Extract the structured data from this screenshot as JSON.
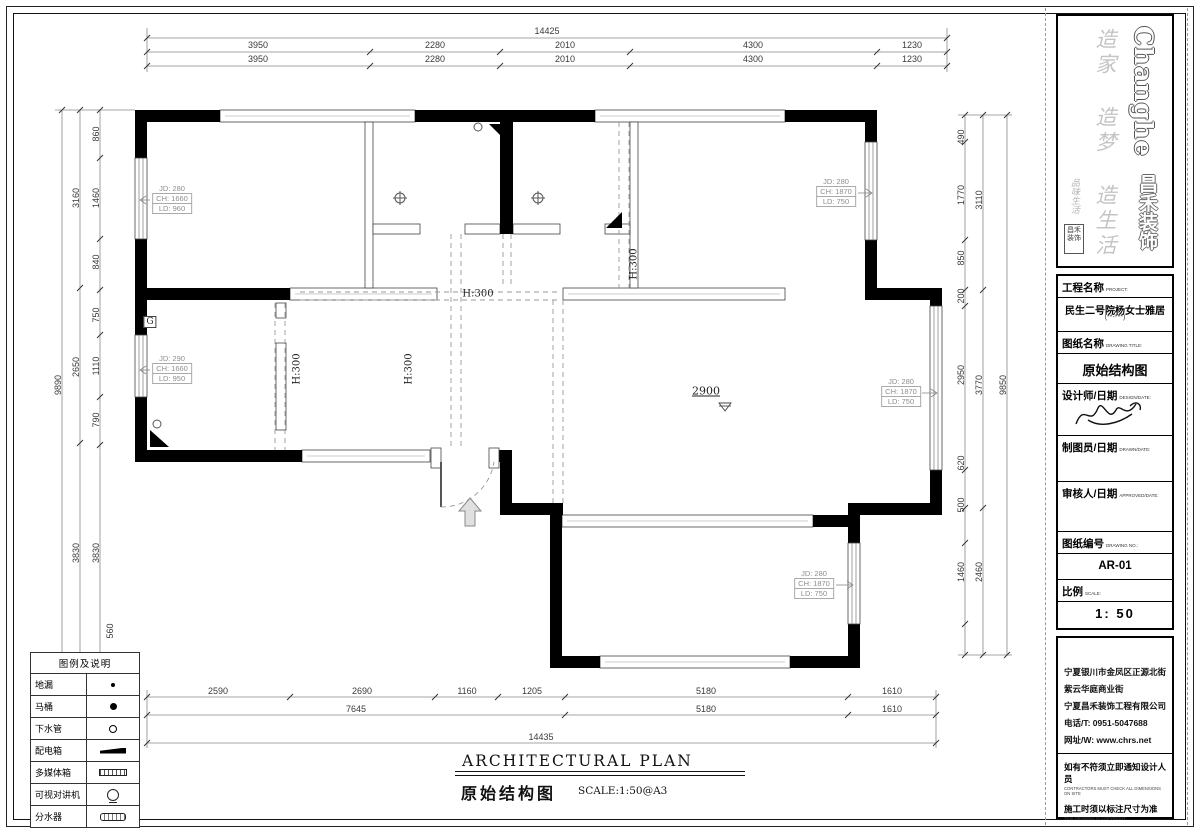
{
  "logo": {
    "brand_en": "Changhe",
    "brand_cn": "昌禾装饰",
    "slogan": "造家 造梦 造生活",
    "calligraphy": "品味生活",
    "seal": "昌禾装饰"
  },
  "title_block": {
    "project_label": "工程名称",
    "project_label_en": "PROJECT:",
    "project_value": "民生二号院杨女士雅居",
    "project_value_sub": "(**-***)",
    "drawing_label": "图纸名称",
    "drawing_label_en": "DRAWING TITLE:",
    "drawing_value": "原始结构图",
    "designer_label": "设计师/日期",
    "designer_label_en": "DESIGN/DATE:",
    "drafter_label": "制图员/日期",
    "drafter_label_en": "DRAWN/DATE:",
    "approver_label": "审核人/日期",
    "approver_label_en": "APPROVED/DATE:",
    "number_label": "图纸编号",
    "number_label_en": "DRAWING NO.:",
    "number_value": "AR-01",
    "scale_label": "比例",
    "scale_label_en": "SCALE:",
    "scale_value": "1: 50"
  },
  "company": {
    "addr1": "宁夏银川市金凤区正源北街",
    "addr2": "紫云华庭商业街",
    "name": "宁夏昌禾装饰工程有限公司",
    "phone": "电话/T: 0951-5047688",
    "web": "网址/W: www.chrs.net",
    "note1_cn": "如有不符须立即通知设计人员",
    "note1_en": "CONTRACTORS MUST CHECK ALL DIMENSIONS ON SITE",
    "note2_cn": "施工时须以标注尺寸为准",
    "note2_en": "THIS DRAWING IS COPYRIGHT"
  },
  "legend": {
    "title": "图例及说明",
    "items": [
      {
        "label": "地漏",
        "symbol": "dot1"
      },
      {
        "label": "马桶",
        "symbol": "dot2"
      },
      {
        "label": "下水管",
        "symbol": "ring"
      },
      {
        "label": "配电箱",
        "symbol": "power"
      },
      {
        "label": "多媒体箱",
        "symbol": "media"
      },
      {
        "label": "可视对讲机",
        "symbol": "intercom"
      },
      {
        "label": "分水器",
        "symbol": "manifold"
      }
    ]
  },
  "plan_title": {
    "en": "ARCHITECTURAL PLAN",
    "cn": "原始结构图",
    "scale": "SCALE:1:50@A3"
  },
  "annotations": {
    "dims": [
      {
        "t": "14425",
        "x": 547,
        "y": 31
      },
      {
        "t": "3950",
        "x": 258,
        "y": 45
      },
      {
        "t": "2280",
        "x": 435,
        "y": 45
      },
      {
        "t": "2010",
        "x": 565,
        "y": 45
      },
      {
        "t": "4300",
        "x": 753,
        "y": 45
      },
      {
        "t": "1230",
        "x": 912,
        "y": 45
      },
      {
        "t": "3950",
        "x": 258,
        "y": 59
      },
      {
        "t": "2280",
        "x": 435,
        "y": 59
      },
      {
        "t": "2010",
        "x": 565,
        "y": 59
      },
      {
        "t": "4300",
        "x": 753,
        "y": 59
      },
      {
        "t": "1230",
        "x": 912,
        "y": 59
      },
      {
        "t": "2590",
        "x": 218,
        "y": 691
      },
      {
        "t": "2690",
        "x": 362,
        "y": 691
      },
      {
        "t": "1160",
        "x": 467,
        "y": 691
      },
      {
        "t": "1205",
        "x": 532,
        "y": 691
      },
      {
        "t": "5180",
        "x": 706,
        "y": 691
      },
      {
        "t": "1610",
        "x": 892,
        "y": 691
      },
      {
        "t": "7645",
        "x": 356,
        "y": 709
      },
      {
        "t": "5180",
        "x": 706,
        "y": 709
      },
      {
        "t": "1610",
        "x": 892,
        "y": 709
      },
      {
        "t": "14435",
        "x": 541,
        "y": 737
      },
      {
        "t": "860",
        "x": 96,
        "y": 134,
        "r": -90
      },
      {
        "t": "1460",
        "x": 96,
        "y": 198,
        "r": -90
      },
      {
        "t": "840",
        "x": 96,
        "y": 262,
        "r": -90
      },
      {
        "t": "750",
        "x": 96,
        "y": 315,
        "r": -90
      },
      {
        "t": "1110",
        "x": 96,
        "y": 366,
        "r": -90
      },
      {
        "t": "790",
        "x": 96,
        "y": 420,
        "r": -90
      },
      {
        "t": "3830",
        "x": 96,
        "y": 553,
        "r": -90
      },
      {
        "t": "560",
        "x": 110,
        "y": 631,
        "r": -90
      },
      {
        "t": "3160",
        "x": 76,
        "y": 198,
        "r": -90
      },
      {
        "t": "2650",
        "x": 76,
        "y": 367,
        "r": -90
      },
      {
        "t": "3830",
        "x": 76,
        "y": 553,
        "r": -90
      },
      {
        "t": "9890",
        "x": 58,
        "y": 385,
        "r": -90
      },
      {
        "t": "490",
        "x": 961,
        "y": 137,
        "r": -90
      },
      {
        "t": "1770",
        "x": 961,
        "y": 195,
        "r": -90
      },
      {
        "t": "850",
        "x": 961,
        "y": 258,
        "r": -90
      },
      {
        "t": "200",
        "x": 961,
        "y": 296,
        "r": -90
      },
      {
        "t": "2950",
        "x": 961,
        "y": 375,
        "r": -90
      },
      {
        "t": "620",
        "x": 961,
        "y": 463,
        "r": -90
      },
      {
        "t": "500",
        "x": 961,
        "y": 505,
        "r": -90
      },
      {
        "t": "1460",
        "x": 961,
        "y": 572,
        "r": -90
      },
      {
        "t": "3110",
        "x": 979,
        "y": 200,
        "r": -90
      },
      {
        "t": "3770",
        "x": 979,
        "y": 385,
        "r": -90
      },
      {
        "t": "2460",
        "x": 979,
        "y": 572,
        "r": -90
      },
      {
        "t": "9850",
        "x": 1003,
        "y": 385,
        "r": -90
      }
    ],
    "plan_labels": [
      {
        "t": "H:300",
        "x": 478,
        "y": 294
      },
      {
        "t": "H:300",
        "x": 297,
        "y": 369,
        "r": -90
      },
      {
        "t": "H:300",
        "x": 409,
        "y": 369,
        "r": -90
      },
      {
        "t": "H:300",
        "x": 634,
        "y": 264,
        "r": -90
      },
      {
        "t": "G",
        "x": 150,
        "y": 322,
        "cls": "gbox"
      },
      {
        "t": "2900",
        "x": 706,
        "y": 391,
        "cls": "level"
      }
    ],
    "window_tags": [
      {
        "x": 172,
        "y": 199,
        "lines": [
          "JD: 280",
          "CH: 1660",
          "LD: 960"
        ]
      },
      {
        "x": 172,
        "y": 369,
        "lines": [
          "JD: 290",
          "CH: 1660",
          "LD: 950"
        ]
      },
      {
        "x": 836,
        "y": 192,
        "lines": [
          "JD: 280",
          "CH: 1870",
          "LD: 750"
        ]
      },
      {
        "x": 901,
        "y": 392,
        "lines": [
          "JD: 280",
          "CH: 1870",
          "LD: 750"
        ]
      },
      {
        "x": 814,
        "y": 584,
        "lines": [
          "JD: 280",
          "CH: 1870",
          "LD: 750"
        ]
      }
    ]
  }
}
